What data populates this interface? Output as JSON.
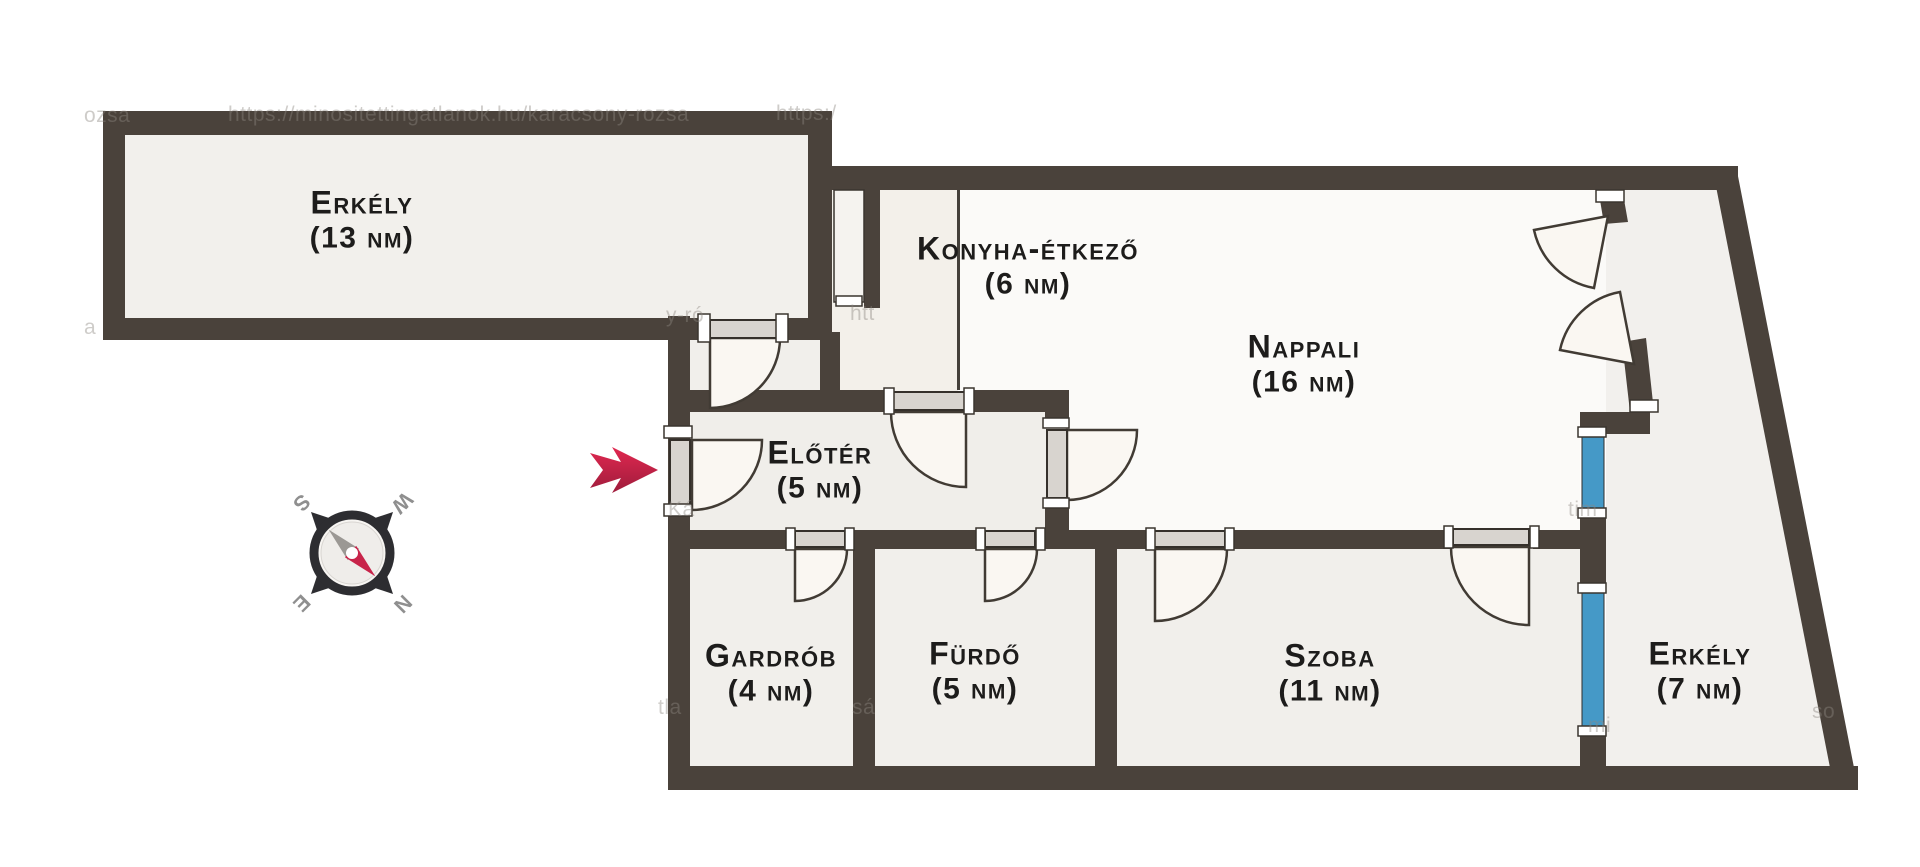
{
  "title": "Lakás alaprajz",
  "rooms": [
    {
      "id": "erkely-13",
      "name": "Erkély",
      "area": "(13 nm)"
    },
    {
      "id": "konyha",
      "name": "Konyha-étkező",
      "area": "(6 nm)"
    },
    {
      "id": "nappali",
      "name": "Nappali",
      "area": "(16 nm)"
    },
    {
      "id": "eloter",
      "name": "Előtér",
      "area": "(5 nm)"
    },
    {
      "id": "gardrob",
      "name": "Gardrób",
      "area": "(4 nm)"
    },
    {
      "id": "furdo",
      "name": "Fürdő",
      "area": "(5 nm)"
    },
    {
      "id": "szoba",
      "name": "Szoba",
      "area": "(11 nm)"
    },
    {
      "id": "erkely-7",
      "name": "Erkély",
      "area": "(7 nm)"
    }
  ],
  "compass": {
    "letters": {
      "n": "N",
      "e": "E",
      "s": "S",
      "w": "W"
    },
    "rotation_deg": 135
  },
  "watermark": {
    "main": "https://minositettingatlanok.hu/karacsony-rozsa",
    "fragments": [
      {
        "text": "ozsa"
      },
      {
        "text": "https:/"
      },
      {
        "text": "y-ró"
      },
      {
        "text": "htt"
      },
      {
        "text": "Ká"
      },
      {
        "text": "tla"
      },
      {
        "text": "sá"
      },
      {
        "text": "tim"
      },
      {
        "text": "mi"
      },
      {
        "text": "so"
      },
      {
        "text": "a"
      }
    ]
  },
  "colors": {
    "wall": "#4a423b",
    "floor": "#f1efeb",
    "floor_light": "#fbfaf8",
    "window_blue": "#4599c7",
    "door_slab": "#d8d4cf",
    "door_swing": "#faf7f2",
    "arrow_red": "#d6224c",
    "compass_dark": "#2d2d31",
    "compass_needle_red": "#c8244a"
  }
}
